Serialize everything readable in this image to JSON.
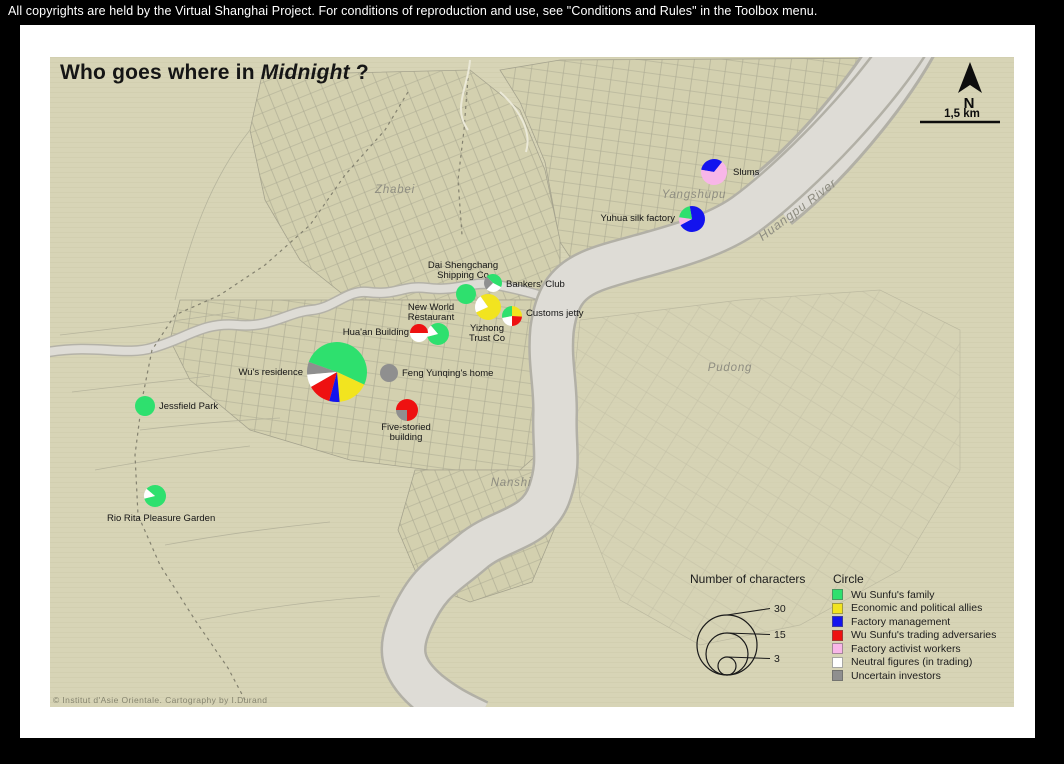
{
  "top_bar": {
    "text": "All copyrights are held by the Virtual Shanghai Project. For conditions of reproduction and use, see \"Conditions and Rules\" in the Toolbox menu."
  },
  "title": {
    "prefix": "Who goes where in ",
    "em": "Midnight",
    "suffix": " ?"
  },
  "north": {
    "label": "N"
  },
  "scale": {
    "label": "1,5 km"
  },
  "credit": "© Institut d'Asie Orientale. Cartography  by  I.Durand",
  "palette": {
    "wu_family": "#2ee06e",
    "allies": "#f2e41f",
    "factory_management": "#1313ee",
    "adversaries": "#ee1111",
    "factory_activists": "#f8b6e8",
    "neutral": "#ffffff",
    "uncertain": "#8f8f8f"
  },
  "legend_categories": {
    "title": "Circle",
    "items": [
      {
        "key": "wu_family",
        "label": "Wu Sunfu's family"
      },
      {
        "key": "allies",
        "label": "Economic and political allies"
      },
      {
        "key": "factory_management",
        "label": "Factory management"
      },
      {
        "key": "adversaries",
        "label": "Wu Sunfu's trading adversaries"
      },
      {
        "key": "factory_activists",
        "label": "Factory activist workers"
      },
      {
        "key": "neutral",
        "label": "Neutral figures (in trading)"
      },
      {
        "key": "uncertain",
        "label": "Uncertain investors"
      }
    ]
  },
  "legend_size": {
    "title": "Number of characters",
    "cx": 727,
    "bottom_y": 675,
    "line_x": 770,
    "label_x": 774,
    "circles": [
      {
        "value": "30",
        "r": 30,
        "label_y": 612
      },
      {
        "value": "15",
        "r": 21,
        "label_y": 638
      },
      {
        "value": "3",
        "r": 9,
        "label_y": 662
      }
    ]
  },
  "region_labels": [
    {
      "text": "Zhabei",
      "x": 395,
      "y": 193,
      "size": 11.5
    },
    {
      "text": "Yangshupu",
      "x": 694,
      "y": 198,
      "size": 11.5,
      "color": "#a3919b"
    },
    {
      "text": "Huangpu River",
      "x": 800,
      "y": 213,
      "size": 12.5,
      "rotate": -37,
      "spacing": 2
    },
    {
      "text": "Pudong",
      "x": 730,
      "y": 371,
      "size": 11.5
    },
    {
      "text": "Nanshi",
      "x": 511,
      "y": 486,
      "size": 11.5
    }
  ],
  "pies": [
    {
      "id": "slums",
      "label": "Slums",
      "x": 714,
      "y": 172,
      "r": 13,
      "rotation": 280,
      "segments": [
        {
          "k": "factory_management",
          "f": 0.33
        },
        {
          "k": "factory_activists",
          "f": 0.67
        }
      ],
      "lx": 733,
      "ly": 175,
      "anchor": "start"
    },
    {
      "id": "yuhua-silk-factory",
      "label": "Yuhua silk factory",
      "x": 692,
      "y": 219,
      "r": 13,
      "rotation": 350,
      "segments": [
        {
          "k": "factory_management",
          "f": 0.7
        },
        {
          "k": "factory_activists",
          "f": 0.1
        },
        {
          "k": "wu_family",
          "f": 0.2
        }
      ],
      "lx": 675,
      "ly": 221,
      "anchor": "end"
    },
    {
      "id": "dai-shengchang-shipping-co",
      "label": "Dai Shengchang\nShipping Co",
      "x": 466,
      "y": 294,
      "r": 10,
      "rotation": 0,
      "segments": [
        {
          "k": "wu_family",
          "f": 1
        }
      ],
      "lx": 463,
      "ly": 268,
      "anchor": "middle"
    },
    {
      "id": "bankers-club",
      "label": "Bankers' Club",
      "x": 493,
      "y": 283,
      "r": 9,
      "rotation": 315,
      "segments": [
        {
          "k": "wu_family",
          "f": 0.45
        },
        {
          "k": "neutral",
          "f": 0.3
        },
        {
          "k": "uncertain",
          "f": 0.25
        }
      ],
      "lx": 506,
      "ly": 287,
      "anchor": "start"
    },
    {
      "id": "yizhong-trust-co",
      "label": "Yizhong\nTrust Co",
      "x": 488,
      "y": 307,
      "r": 13,
      "rotation": 325,
      "segments": [
        {
          "k": "allies",
          "f": 0.78
        },
        {
          "k": "neutral",
          "f": 0.22
        }
      ],
      "lx": 487,
      "ly": 331,
      "anchor": "middle"
    },
    {
      "id": "customs-jetty",
      "label": "Customs jetty",
      "x": 512,
      "y": 316,
      "r": 10,
      "rotation": 0,
      "segments": [
        {
          "k": "allies",
          "f": 0.26
        },
        {
          "k": "adversaries",
          "f": 0.24
        },
        {
          "k": "neutral",
          "f": 0.22
        },
        {
          "k": "wu_family",
          "f": 0.28
        }
      ],
      "lx": 526,
      "ly": 316,
      "anchor": "start"
    },
    {
      "id": "new-world-restaurant",
      "label": "New World\nRestaurant",
      "x": 438,
      "y": 334,
      "r": 11,
      "rotation": 320,
      "segments": [
        {
          "k": "wu_family",
          "f": 0.82
        },
        {
          "k": "neutral",
          "f": 0.18
        }
      ],
      "lx": 431,
      "ly": 310,
      "anchor": "middle"
    },
    {
      "id": "huaan-building",
      "label": "Hua'an Building",
      "x": 419,
      "y": 333,
      "r": 9,
      "rotation": 270,
      "segments": [
        {
          "k": "adversaries",
          "f": 0.5
        },
        {
          "k": "neutral",
          "f": 0.5
        }
      ],
      "lx": 409,
      "ly": 335,
      "anchor": "end"
    },
    {
      "id": "wus-residence",
      "label": "Wu's residence",
      "x": 337,
      "y": 372,
      "r": 30,
      "rotation": 265,
      "segments": [
        {
          "k": "uncertain",
          "f": 0.069
        },
        {
          "k": "wu_family",
          "f": 0.514
        },
        {
          "k": "allies",
          "f": 0.167
        },
        {
          "k": "factory_management",
          "f": 0.056
        },
        {
          "k": "adversaries",
          "f": 0.125
        },
        {
          "k": "neutral",
          "f": 0.069
        }
      ],
      "lx": 303,
      "ly": 375,
      "anchor": "end"
    },
    {
      "id": "feng-yunqings-home",
      "label": "Feng Yunqing's home",
      "x": 389,
      "y": 373,
      "r": 9,
      "rotation": 0,
      "segments": [
        {
          "k": "uncertain",
          "f": 1
        }
      ],
      "lx": 402,
      "ly": 376,
      "anchor": "start"
    },
    {
      "id": "five-storied-building",
      "label": "Five-storied\nbuilding",
      "x": 407,
      "y": 410,
      "r": 11,
      "rotation": 270,
      "segments": [
        {
          "k": "adversaries",
          "f": 0.75
        },
        {
          "k": "uncertain",
          "f": 0.25
        }
      ],
      "lx": 406,
      "ly": 430,
      "anchor": "middle"
    },
    {
      "id": "jessfield-park",
      "label": "Jessfield Park",
      "x": 145,
      "y": 406,
      "r": 10,
      "rotation": 0,
      "segments": [
        {
          "k": "wu_family",
          "f": 1
        }
      ],
      "lx": 159,
      "ly": 409,
      "anchor": "start"
    },
    {
      "id": "rio-rita-pleasure-garden",
      "label": "Rio Rita Pleasure Garden",
      "x": 155,
      "y": 496,
      "r": 11,
      "rotation": 310,
      "segments": [
        {
          "k": "wu_family",
          "f": 0.85
        },
        {
          "k": "neutral",
          "f": 0.15
        }
      ],
      "lx": 107,
      "ly": 521,
      "anchor": "start"
    }
  ]
}
